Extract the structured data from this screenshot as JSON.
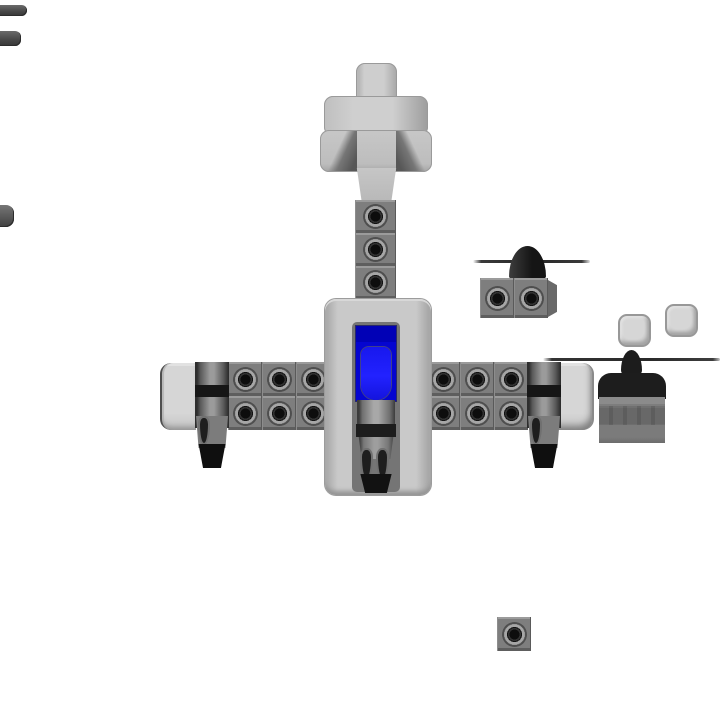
{
  "scene": {
    "app_context": "block-building sandbox game, top-down view of an aircraft under construction with loose parts scattered around",
    "background": "#ffffff"
  },
  "palette": {
    "bg": "#ffffff",
    "light_block": "#c9c9c9",
    "medium_block": "#7e7e7e",
    "cell_hi": "#9b9b9b",
    "cell_lo": "#5e5e5e",
    "cell_gap": "#5a5a5a",
    "dark_part": "#1d1d1d",
    "canopy_blue": "#0505d0",
    "canopy_dark": "#0101b6",
    "windshield_blue": "#2222ff",
    "stud_black": "#0d0d0d",
    "stud_ring": "#a6a6a6"
  },
  "parts": {
    "aircraft": {
      "tail": "cross-shaped light gray tail block",
      "spine": "3 stud blocks linking tail to fuselage",
      "fuselage": "light gray panel with blue cockpit canopy, engine body, black band and twin-prong exhaust",
      "wings": "2 rows x 3 columns of stud blocks per side, engine nacelle with black exhaust, rounded light wing tip"
    },
    "loose_parts": [
      "propeller with dark spinner cone on two stud blocks",
      "two small rounded light gray blocks",
      "radial engine with propeller blade and dark cowl",
      "single stud block near bottom",
      "three part ends peeking from the left edge"
    ]
  },
  "stud_grids": [
    {
      "name": "spine",
      "x": 355,
      "y": 200,
      "cols": 1,
      "rows": 3,
      "cw": 41,
      "ch": 33
    },
    {
      "name": "left-wing",
      "x": 228,
      "y": 362,
      "cols": 3,
      "rows": 2,
      "cw": 34,
      "ch": 34
    },
    {
      "name": "right-wing",
      "x": 426,
      "y": 362,
      "cols": 3,
      "rows": 2,
      "cw": 34,
      "ch": 34
    },
    {
      "name": "prop-mount",
      "x": 480,
      "y": 278,
      "cols": 2,
      "rows": 1,
      "cw": 34,
      "ch": 40
    },
    {
      "name": "loose-single",
      "x": 497,
      "y": 617,
      "cols": 1,
      "rows": 1,
      "cw": 34,
      "ch": 34
    }
  ]
}
